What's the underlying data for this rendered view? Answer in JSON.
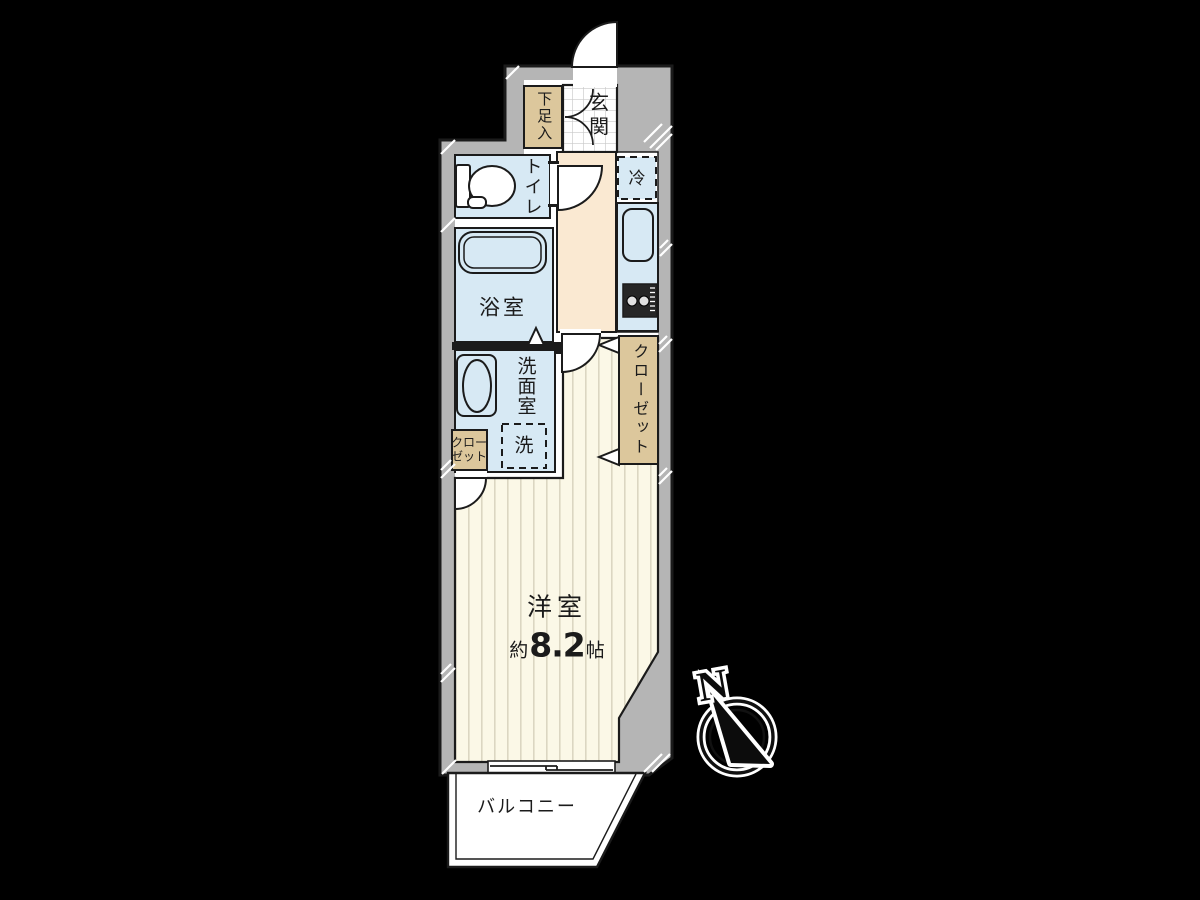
{
  "plan_title": "1K apartment floor plan",
  "colors": {
    "bg": "#000000",
    "wall": "#b5b5b5",
    "line": "#1b1b1b",
    "water": "#d7e9f4",
    "hall": "#fae9d2",
    "floor": "#fbf8e7",
    "stripe": "#dbd6c2",
    "closet": "#dcc79c",
    "tile_line": "#c9c9c9"
  },
  "rooms": {
    "genkan": {
      "label": "玄関"
    },
    "shoe_box": {
      "label": "下足入"
    },
    "toilet": {
      "label": "トイレ"
    },
    "fridge_space": {
      "label": "冷"
    },
    "bathroom": {
      "label": "浴室"
    },
    "washroom": {
      "label": "洗面室"
    },
    "laundry_space": {
      "label": "洗"
    },
    "closet_small": {
      "label": "クローゼット"
    },
    "closet_main": {
      "label": "クローゼット"
    },
    "western_room": {
      "label": "洋室",
      "size_prefix": "約",
      "size_value": "8.2",
      "size_unit": "帖"
    },
    "balcony": {
      "label": "バルコニー"
    }
  },
  "compass": {
    "north_label": "N"
  }
}
